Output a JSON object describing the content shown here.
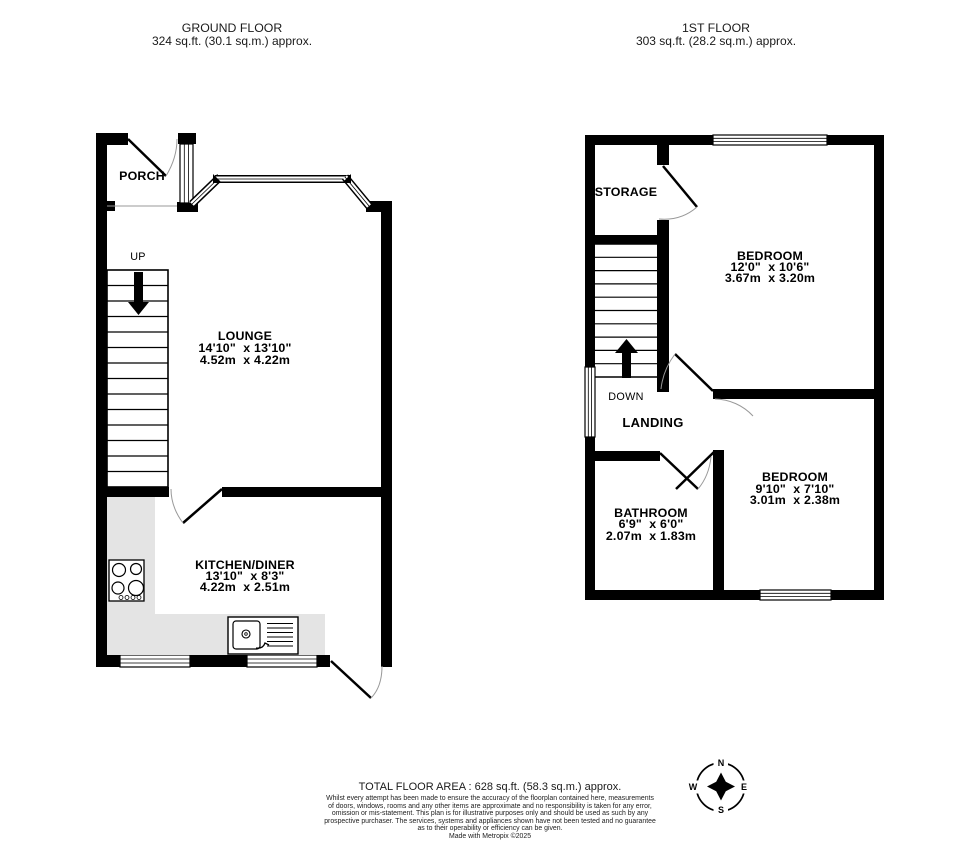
{
  "header": {
    "ground": {
      "title": "GROUND FLOOR",
      "area": "324 sq.ft. (30.1 sq.m.) approx."
    },
    "first": {
      "title": "1ST FLOOR",
      "area": "303 sq.ft. (28.2 sq.m.) approx."
    }
  },
  "ground": {
    "porch": {
      "label": "PORCH"
    },
    "stairs": {
      "label": "UP"
    },
    "lounge": {
      "name": "LOUNGE",
      "imperial": "14'10\"  x 13'10\"",
      "metric": "4.52m  x 4.22m"
    },
    "kitchen": {
      "name": "KITCHEN/DINER",
      "imperial": "13'10\"  x 8'3\"",
      "metric": "4.22m  x 2.51m"
    }
  },
  "first": {
    "storage": {
      "label": "STORAGE"
    },
    "stairs": {
      "label": "DOWN"
    },
    "landing": {
      "label": "LANDING"
    },
    "bedroom1": {
      "name": "BEDROOM",
      "imperial": "12'0\"  x 10'6\"",
      "metric": "3.67m  x 3.20m"
    },
    "bedroom2": {
      "name": "BEDROOM",
      "imperial": "9'10\"  x 7'10\"",
      "metric": "3.01m  x 2.38m"
    },
    "bathroom": {
      "name": "BATHROOM",
      "imperial": "6'9\"  x 6'0\"",
      "metric": "2.07m  x 1.83m"
    }
  },
  "compass": {
    "n": "N",
    "e": "E",
    "s": "S",
    "w": "W"
  },
  "footer": {
    "total": "TOTAL FLOOR AREA : 628 sq.ft. (58.3 sq.m.) approx.",
    "disclaimer": [
      "Whilst every attempt has been made to ensure the accuracy of the floorplan contained here, measurements",
      "of doors, windows, rooms and any other items are approximate and no responsibility is taken for any error,",
      "omission or mis-statement. This plan is for illustrative purposes only and should be used as such by any",
      "prospective purchaser. The services, systems and appliances shown have not been tested and no guarantee",
      "as to their operability or efficiency can be given."
    ],
    "credit": "Made with Metropix ©2025"
  },
  "colors": {
    "wall": "#000000",
    "counter": "#e4e4e4",
    "door_arc": "#999999"
  }
}
